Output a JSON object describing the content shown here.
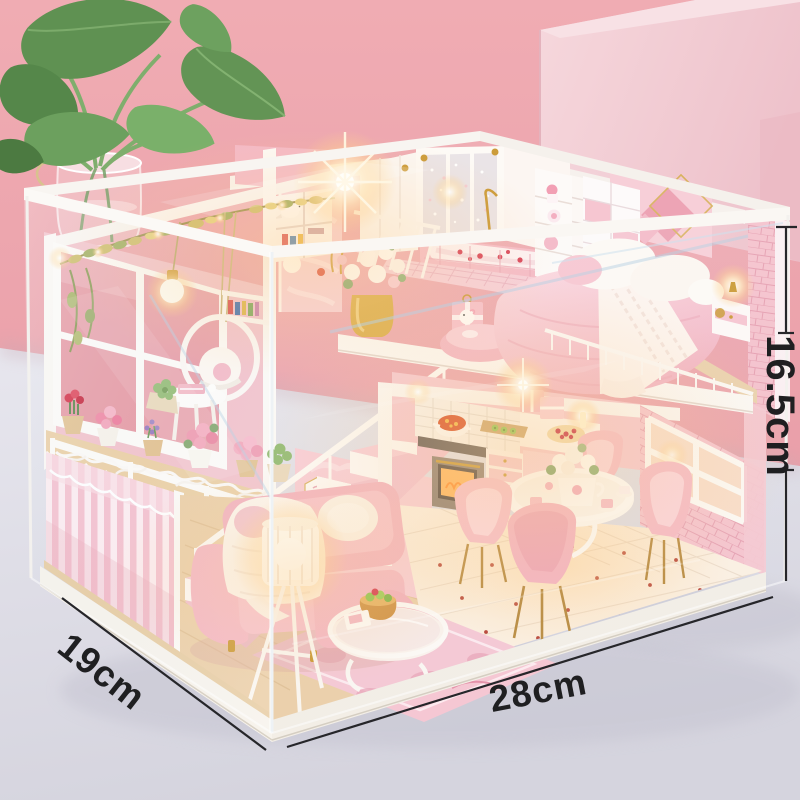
{
  "scene": {
    "subject": "diy-miniature-dollhouse-product-photo",
    "backdrop": "pink studio wall with pink display block and pothos plant",
    "cover": "clear acrylic dust cover with white wooden frame",
    "rooms": "loft bedroom, bathroom, balcony garden, living room, kitchen, dining area"
  },
  "annotations": {
    "height": "16.5cm",
    "depth": "19cm",
    "width": "28cm"
  },
  "colors": {
    "backdrop_pink": "#eda7af",
    "pedestal_pink": "#f4d2d8",
    "table_gray": "#dcdbe4",
    "house_pink": "#f6c3ce",
    "warm_light": "#ffc985",
    "annotation_text": "#1f1f21"
  }
}
